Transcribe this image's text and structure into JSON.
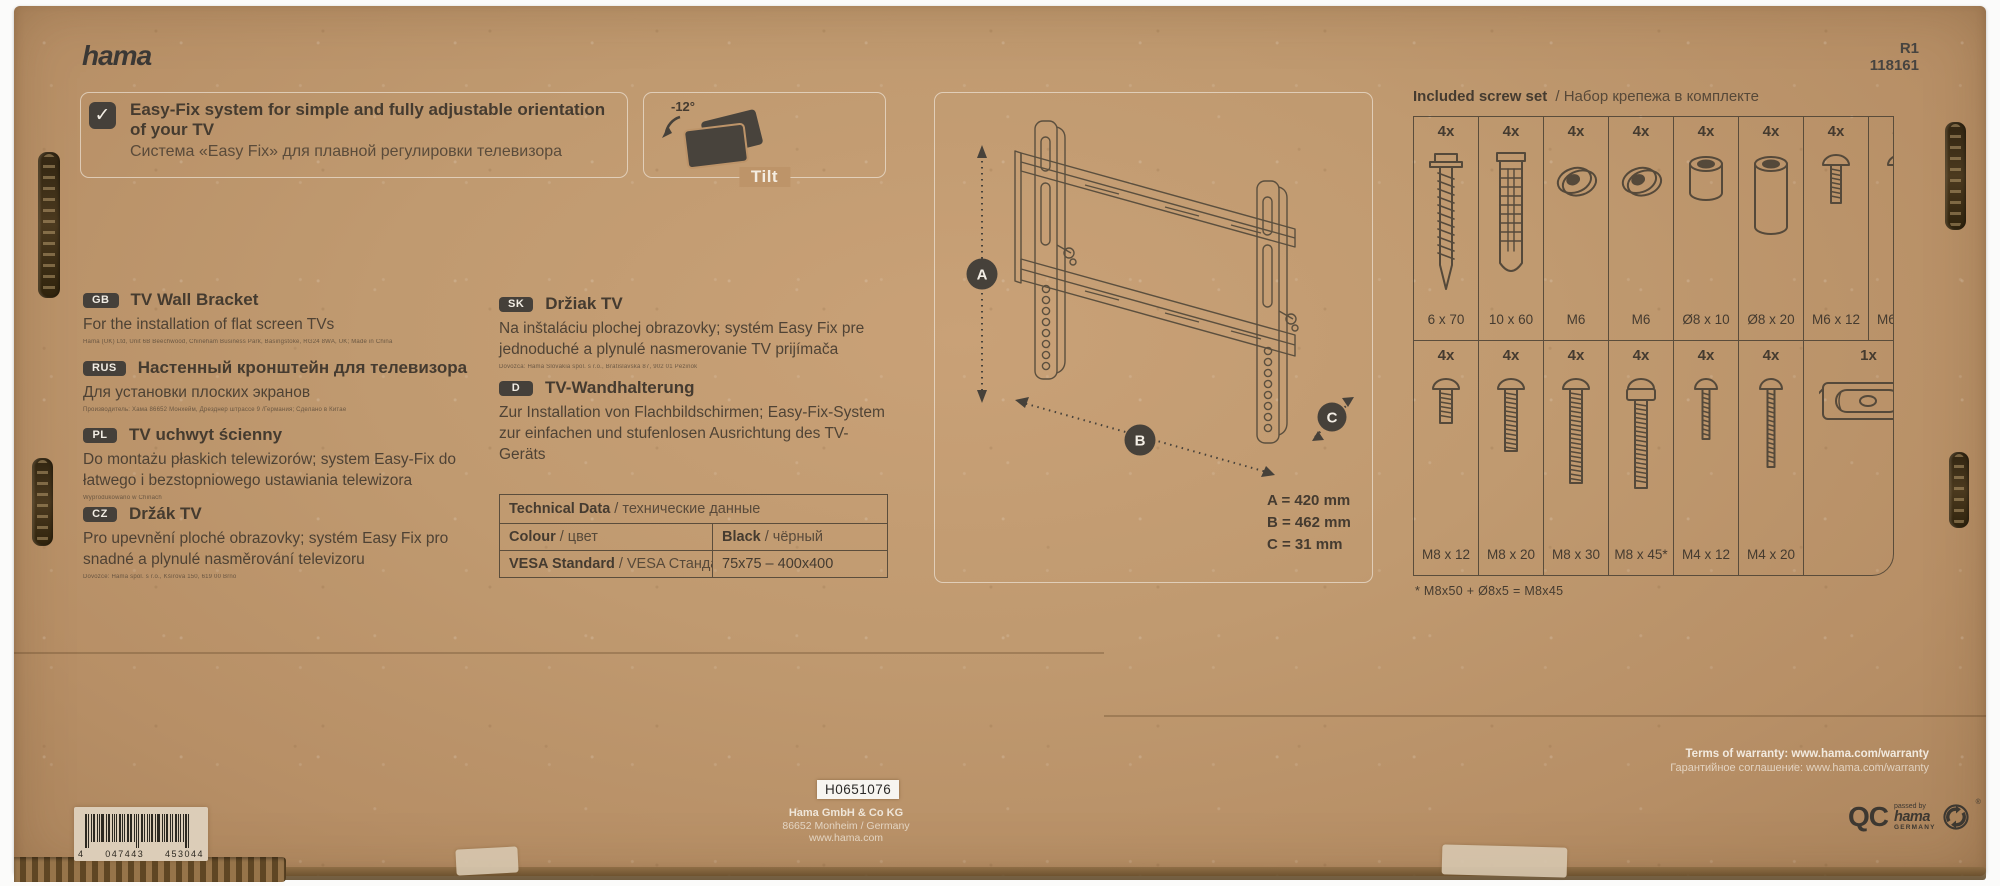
{
  "colors": {
    "cardboard": "#bf9569",
    "ink": "#46413a",
    "print_white": "#f2ece0",
    "badge_bg": "#45403a"
  },
  "brand": {
    "logo": "hama"
  },
  "product": {
    "code1": "R1",
    "code2": "118161"
  },
  "feature": {
    "check_glyph": "✓",
    "title": "Easy-Fix system for simple and fully adjustable orientation of your TV",
    "subtitle": "Система «Easy Fix» для плавной регулировки телевизора"
  },
  "tilt": {
    "angle": "-12°",
    "label": "Tilt"
  },
  "languages": [
    {
      "code": "GB",
      "title": "TV Wall Bracket",
      "desc": "For the installation of flat screen TVs",
      "fine": "Hama (UK) Ltd, Unit 6B Beechwood, Chineham Business Park, Basingstoke, RG24 8WA, UK; Made in China"
    },
    {
      "code": "RUS",
      "title": "Настенный кронштейн для телевизора",
      "desc": "Для установки плоских экранов",
      "fine": "Производитель: Хама 86652 Монхейм, Дрезднер штрассе 9 /Германия; Сделано в Китае"
    },
    {
      "code": "PL",
      "title": "TV uchwyt ścienny",
      "desc": "Do montażu płaskich telewizorów; system Easy-Fix do łatwego i bezstopniowego ustawiania telewizora",
      "fine": "Wyprodukowano w Chinach"
    },
    {
      "code": "CZ",
      "title": "Držák TV",
      "desc": "Pro upevnění ploché obrazovky; systém Easy Fix pro snadné a plynulé nasměrování televizoru",
      "fine": "Dovozce: Hama spol. s r.o., Kšírova 150, 619 00 Brno"
    },
    {
      "code": "SK",
      "title": "Držiak TV",
      "desc": "Na inštaláciu plochej obrazovky; systém Easy Fix pre jednoduché a plynulé nasmerovanie TV prijímača",
      "fine": "Dovozca: Hama Slovakia spol. s r.o., Bratislavská 87, 902 01 Pezinok"
    },
    {
      "code": "D",
      "title": "TV-Wandhalterung",
      "desc": "Zur Installation von Flachbildschirmen; Easy-Fix-System zur einfachen und stufenlosen Ausrichtung des TV-Geräts",
      "fine": ""
    }
  ],
  "technical_table": {
    "header_en": "Technical Data",
    "header_ru": "/ технические данные",
    "rows": [
      {
        "label_en": "Colour",
        "label_ru": "/ цвет",
        "value_en": "Black",
        "value_ru": "/ чёрный"
      },
      {
        "label_en": "VESA Standard",
        "label_ru": "/ VESA Стандарт",
        "value_en": "75x75 – 400x400",
        "value_ru": ""
      }
    ]
  },
  "dimensions": {
    "marker_a": "A",
    "marker_b": "B",
    "marker_c": "C",
    "a": "A = 420 mm",
    "b": "B = 462 mm",
    "c": "C = 31 mm"
  },
  "screw_set": {
    "title_en": "Included screw set",
    "title_ru": "/  Набор крепежа в комплекте",
    "row1": [
      {
        "qty": "4x",
        "label": "6 x 70",
        "icon": "wood-screw"
      },
      {
        "qty": "4x",
        "label": "10 x 60",
        "icon": "wall-anchor"
      },
      {
        "qty": "4x",
        "label": "M6",
        "icon": "washer"
      },
      {
        "qty": "4x",
        "label": "M6",
        "icon": "washer"
      },
      {
        "qty": "4x",
        "label": "Ø8 x 10",
        "icon": "spacer-short"
      },
      {
        "qty": "4x",
        "label": "Ø8 x 20",
        "icon": "spacer-long"
      },
      {
        "qty": "4x",
        "label": "M6 x 12",
        "icon": "machine-screw-short"
      },
      {
        "qty": "4x",
        "label": "M6 x 20",
        "icon": "machine-screw-long"
      }
    ],
    "row2": [
      {
        "qty": "4x",
        "label": "M8 x 12",
        "icon": "bolt-m8-12"
      },
      {
        "qty": "4x",
        "label": "M8 x 20",
        "icon": "bolt-m8-20"
      },
      {
        "qty": "4x",
        "label": "M8 x 30",
        "icon": "bolt-m8-30"
      },
      {
        "qty": "4x",
        "label": "M8 x 45*",
        "icon": "bolt-m8-45-spacer"
      },
      {
        "qty": "4x",
        "label": "M4 x 12",
        "icon": "bolt-m4-12"
      },
      {
        "qty": "4x",
        "label": "M4 x 20",
        "icon": "bolt-m4-20"
      },
      {
        "qty": "1x",
        "label": "",
        "icon": "spirit-level",
        "span": 2
      }
    ],
    "footnote": "* M8x50 + Ø8x5 = M8x45"
  },
  "bottom": {
    "batch_label": "H0651076",
    "manufacturer": "Hama GmbH & Co KG",
    "address": "86652 Monheim / Germany",
    "website": "www.hama.com",
    "warranty_en": "Terms of warranty: www.hama.com/warranty",
    "warranty_ru": "Гарантийное соглашение: www.hama.com/warranty",
    "barcode": {
      "d1": "4",
      "d2": "047443",
      "d3": "453044"
    },
    "qc": {
      "letters": "QC",
      "passed": "passed by",
      "brand": "hama",
      "country": "GERMANY",
      "reg": "®"
    }
  }
}
